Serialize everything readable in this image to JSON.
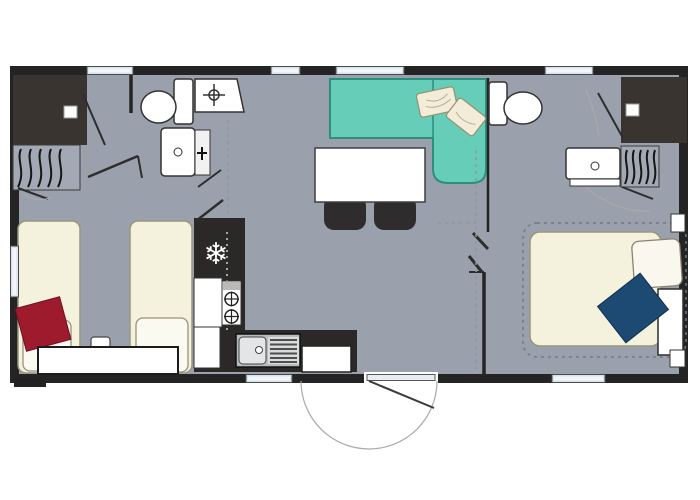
{
  "meta": {
    "title": "Mobile home floor plan",
    "canvas_width": 700,
    "canvas_height": 500
  },
  "colors": {
    "page_bg": "#ffffff",
    "floor": "#9aa1ac",
    "wall": "#242424",
    "dark_unit": "#3a3430",
    "counter": "#2b2927",
    "fixture": "#ffffff",
    "window": "#d7e4ee",
    "sofa": "#66cdb8",
    "sofa_border": "#2d8e7e",
    "bed": "#f4f1dc",
    "pillow": "#fbfaf0",
    "pillow_red": "#9e1a2d",
    "pillow_navy": "#1c4a73",
    "chair": "#2e2c2c",
    "wardrobe": "#a2a9b4",
    "stainless": "#b9bcbe",
    "dash": "#8d97a5"
  },
  "icons": {
    "freezer_glyph": "❄",
    "drain_symbol": "cross-in-circle",
    "burner_symbol": "cross-in-circle"
  },
  "elements": {
    "beds": [
      "single-bed",
      "single-bed",
      "double-bed"
    ],
    "seating": [
      "corner-sofa",
      "dining-chair",
      "dining-chair"
    ],
    "tables": [
      "dining-table",
      "bedside-unit",
      "foot-bench"
    ],
    "sanitary": [
      "toilet",
      "toilet",
      "shower-tray",
      "shower-cubicle",
      "shower-cubicle",
      "washbasin",
      "washbasin"
    ],
    "kitchen": [
      "fridge-freezer",
      "gas-hob-2-burners",
      "sink-with-drainer",
      "kitchen-cabinet",
      "kitchen-cabinet",
      "kitchen-cabinet"
    ],
    "storage": [
      "wardrobe-with-hangers",
      "wardrobe-with-hangers",
      "corner-cupboard"
    ],
    "cushions": [
      "red-cushion",
      "navy-cushion",
      "white-pillow",
      "white-pillow",
      "white-pillow",
      "sofa-cushion",
      "sofa-cushion"
    ],
    "doors": [
      "entrance-door-with-swing",
      "interior-door",
      "interior-door",
      "bifold-door"
    ],
    "window_count": 7
  }
}
